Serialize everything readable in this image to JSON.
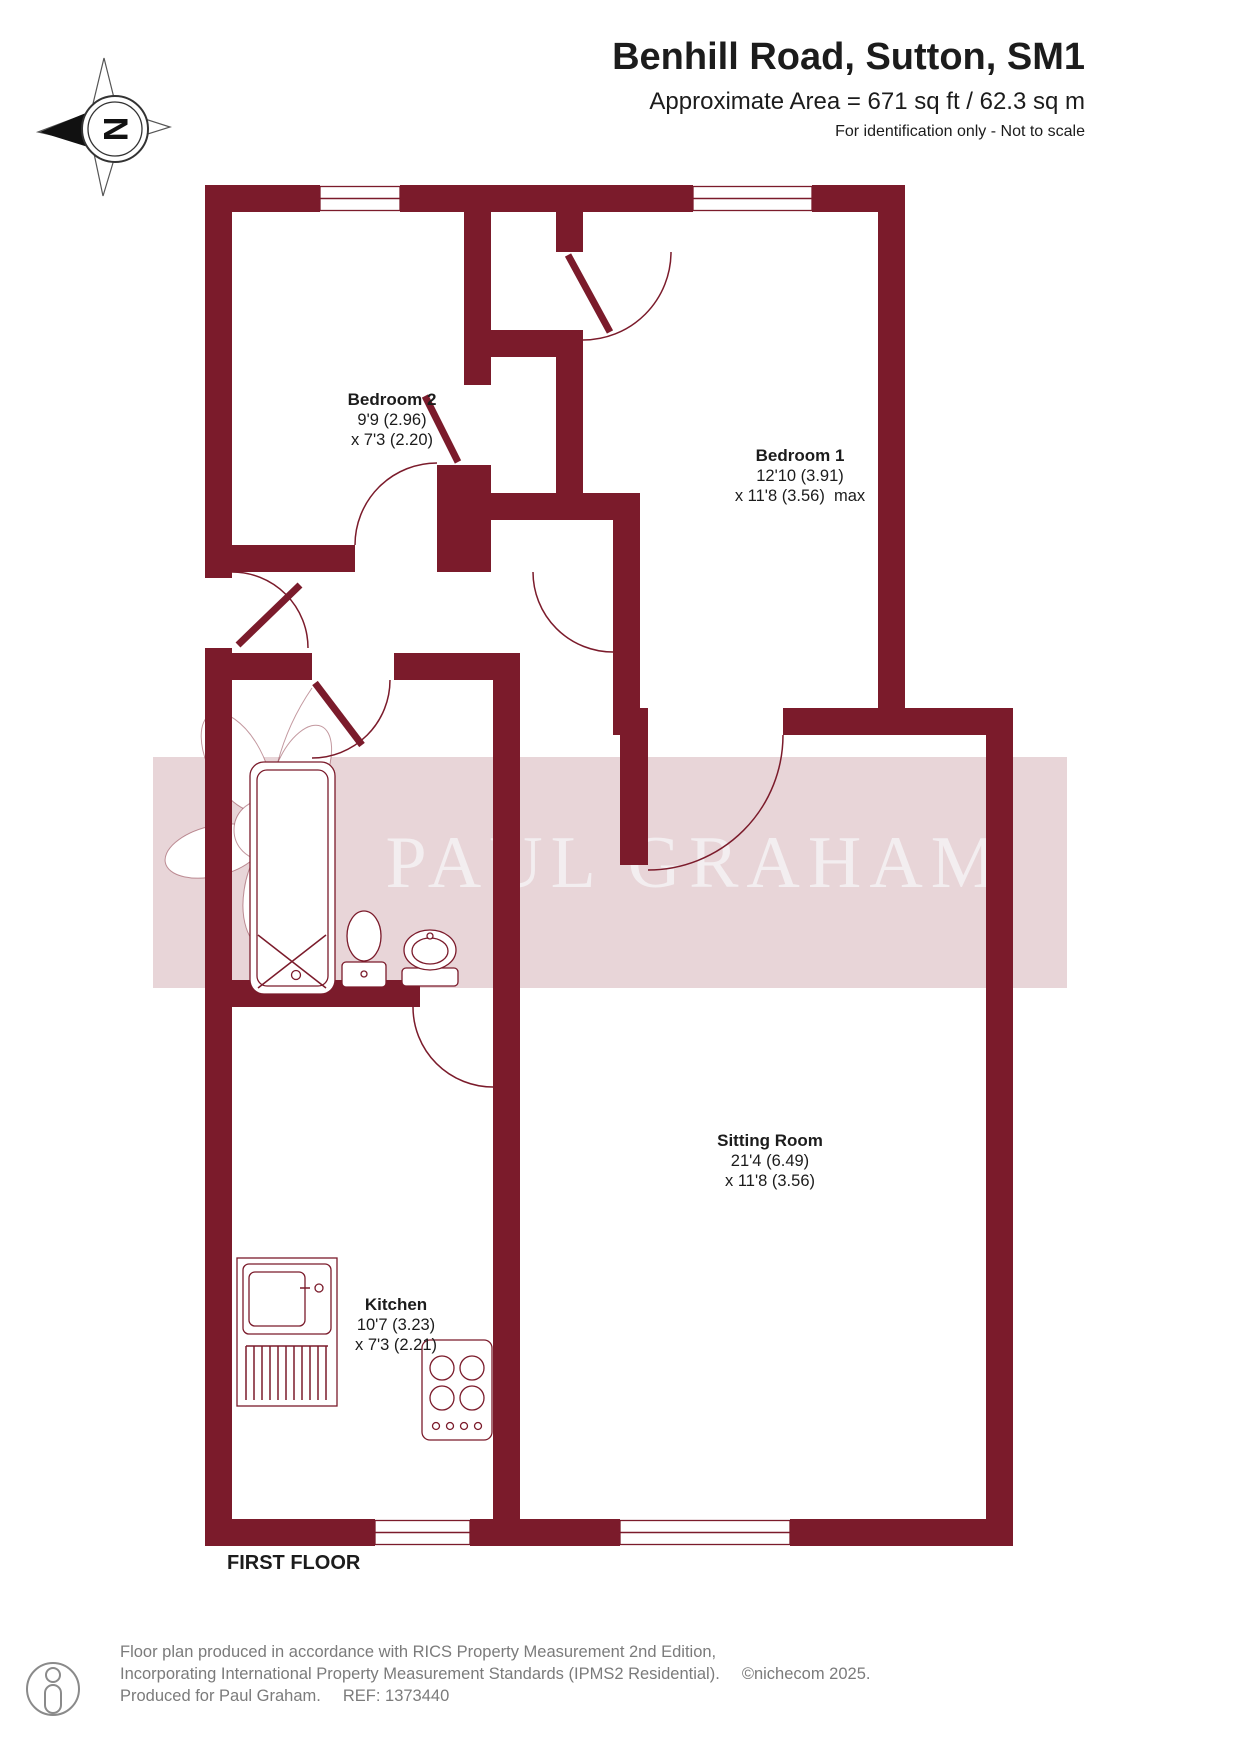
{
  "header": {
    "title": "Benhill Road, Sutton, SM1",
    "area_line": "Approximate Area = 671 sq ft / 62.3 sq m",
    "disclaimer": "For identification only - Not to scale"
  },
  "compass": {
    "letter": "N"
  },
  "watermark": {
    "text": "PAUL GRAHAM"
  },
  "floor_label": "FIRST FLOOR",
  "rooms": {
    "bedroom2": {
      "name": "Bedroom 2",
      "dim1": "9'9 (2.96)",
      "dim2": "x 7'3 (2.20)"
    },
    "bedroom1": {
      "name": "Bedroom 1",
      "dim1": "12'10 (3.91)",
      "dim2": "x 11'8 (3.56)  max"
    },
    "sitting_room": {
      "name": "Sitting Room",
      "dim1": "21'4 (6.49)",
      "dim2": "x 11'8 (3.56)"
    },
    "kitchen": {
      "name": "Kitchen",
      "dim1": "10'7 (3.23)",
      "dim2": "x 7'3 (2.21)"
    }
  },
  "footer": {
    "line1": "Floor plan produced in accordance with RICS Property Measurement 2nd Edition,",
    "line2": "Incorporating International Property Measurement Standards (IPMS2 Residential).",
    "line2_copyright": "©nichecom 2025.",
    "line3": "Produced for Paul Graham.",
    "line3_ref": "REF: 1373440"
  },
  "colors": {
    "wall": "#7b1b2b",
    "watermark_band": "#e8d5d8",
    "watermark_text": "#f3eef0"
  }
}
